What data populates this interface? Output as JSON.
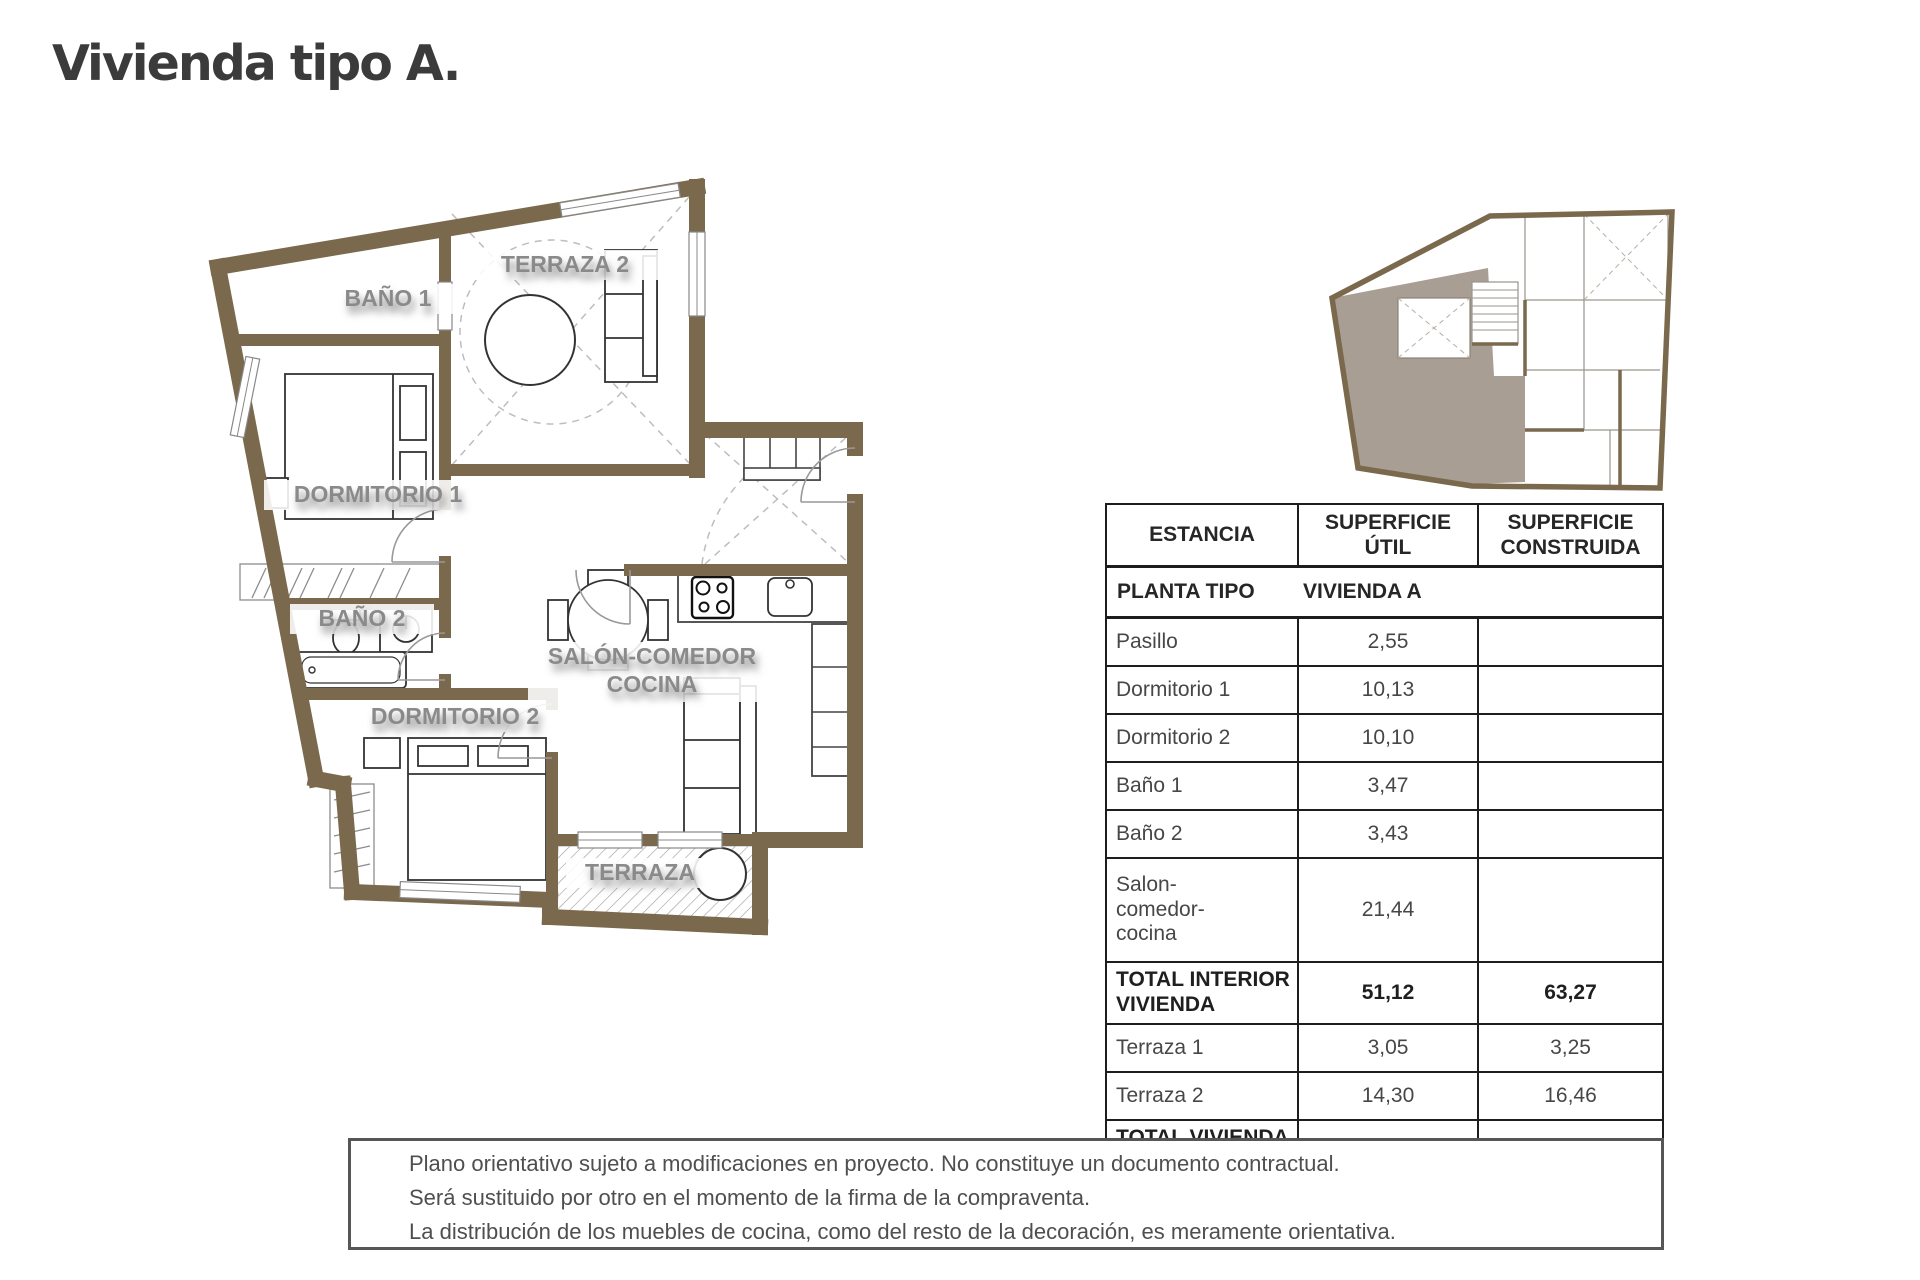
{
  "title": "Vivienda tipo A.",
  "plan": {
    "wall_color": "#7a694c",
    "labels": {
      "terraza2": "TERRAZA 2",
      "bano1": "BAÑO 1",
      "dormitorio1": "DORMITORIO 1",
      "bano2": "BAÑO 2",
      "dormitorio2": "DORMITORIO 2",
      "salon_line1": "SALÓN-COMEDOR",
      "salon_line2": "COCINA",
      "terraza": "TERRAZA"
    }
  },
  "key_plan": {
    "highlight_color": "#a89e93"
  },
  "table": {
    "header": {
      "estancia": "ESTANCIA",
      "util": "SUPERFICIE\nÚTIL",
      "construida": "SUPERFICIE\nCONSTRUIDA"
    },
    "subheader": {
      "label": "PLANTA TIPO",
      "value": "VIVIENDA A"
    },
    "rows": [
      {
        "name": "Pasillo",
        "util": "2,55",
        "construida": ""
      },
      {
        "name": "Dormitorio 1",
        "util": "10,13",
        "construida": ""
      },
      {
        "name": "Dormitorio 2",
        "util": "10,10",
        "construida": ""
      },
      {
        "name": "Baño 1",
        "util": "3,47",
        "construida": ""
      },
      {
        "name": "Baño 2",
        "util": "3,43",
        "construida": ""
      },
      {
        "name": "Salon-\ncomedor-\ncocina",
        "util": "21,44",
        "construida": ""
      },
      {
        "name": "TOTAL INTERIOR\nVIVIENDA",
        "util": "51,12",
        "construida": "63,27"
      },
      {
        "name": "Terraza 1",
        "util": "3,05",
        "construida": "3,25"
      },
      {
        "name": "Terraza 2",
        "util": "14,30",
        "construida": "16,46"
      },
      {
        "name": "TOTAL VIVIENDA\n+ TERRAZAS",
        "util": "65,84",
        "construida": "78,55"
      }
    ]
  },
  "disclaimer": {
    "lines": [
      "Plano orientativo sujeto a modificaciones en proyecto. No constituye un documento contractual.",
      "Será sustituido por otro en el momento de la firma de la compraventa.",
      "La distribución de los muebles de cocina, como del resto de la decoración, es meramente orientativa."
    ]
  }
}
